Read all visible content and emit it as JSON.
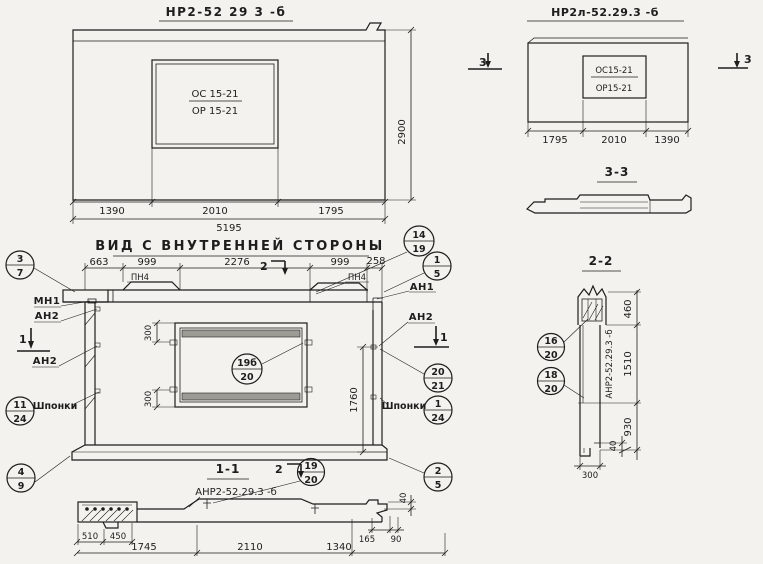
{
  "front_view": {
    "title": "НР2-52 29 3 -б",
    "opening_mark_top": "ОС 15-21",
    "opening_mark_bottom": "ОР 15-21",
    "dim_height": "2900",
    "dims_bottom": [
      "1390",
      "2010",
      "1795"
    ],
    "dim_total": "5195"
  },
  "front_view_left": {
    "title": "НР2л-52.29.3 -б",
    "section_mark": "3",
    "opening_mark_top": "ОС15-21",
    "opening_mark_bottom": "ОР15-21",
    "dims_bottom": [
      "1795",
      "2010",
      "1390"
    ]
  },
  "section_3_3": {
    "title": "3-3"
  },
  "section_2_2": {
    "title": "2-2",
    "dims_right": [
      "460",
      "1510",
      "930"
    ],
    "dim_small": "40",
    "dim_width": "300",
    "assembly_mark": "АНР2-52.29.3 -б",
    "callout_upper": {
      "num": "16",
      "sheet": "20"
    },
    "callout_lower": {
      "num": "18",
      "sheet": "20"
    }
  },
  "inner_view": {
    "title": "ВИД С ВНУТРЕННЕЙ СТОРОНЫ",
    "dims_top": [
      "663",
      "999",
      "2276",
      "999",
      "258"
    ],
    "pn4_label": "ПН4",
    "mn1_label": "МН1",
    "an1_label": "АН1",
    "an2_label": "АН2",
    "keys_label": "Шпонки",
    "dim_window_top": "300",
    "dim_window_bottom": "300",
    "dim_height": "1760",
    "marker_1": "1",
    "marker_2": "2",
    "callouts": {
      "c3_7": {
        "num": "3",
        "sheet": "7"
      },
      "c14_19": {
        "num": "14",
        "sheet": "19"
      },
      "c1_5": {
        "num": "1",
        "sheet": "5"
      },
      "c11_24": {
        "num": "11",
        "sheet": "24"
      },
      "c20_21": {
        "num": "20",
        "sheet": "21"
      },
      "c1_24": {
        "num": "1",
        "sheet": "24"
      },
      "c4_9": {
        "num": "4",
        "sheet": "9"
      },
      "c2_5": {
        "num": "2",
        "sheet": "5"
      },
      "c19b_20": {
        "num": "19б",
        "sheet": "20"
      }
    }
  },
  "section_1_1": {
    "title": "1-1",
    "marker_2": "2",
    "assembly_mark": "АНР2-52.29.3 -б",
    "callout": {
      "num": "19",
      "sheet": "20"
    },
    "dims_left": [
      "510",
      "450"
    ],
    "dims_bottom": [
      "1745",
      "2110",
      "1340"
    ],
    "dims_end": [
      "165",
      "90"
    ],
    "dim_lip": "40"
  }
}
